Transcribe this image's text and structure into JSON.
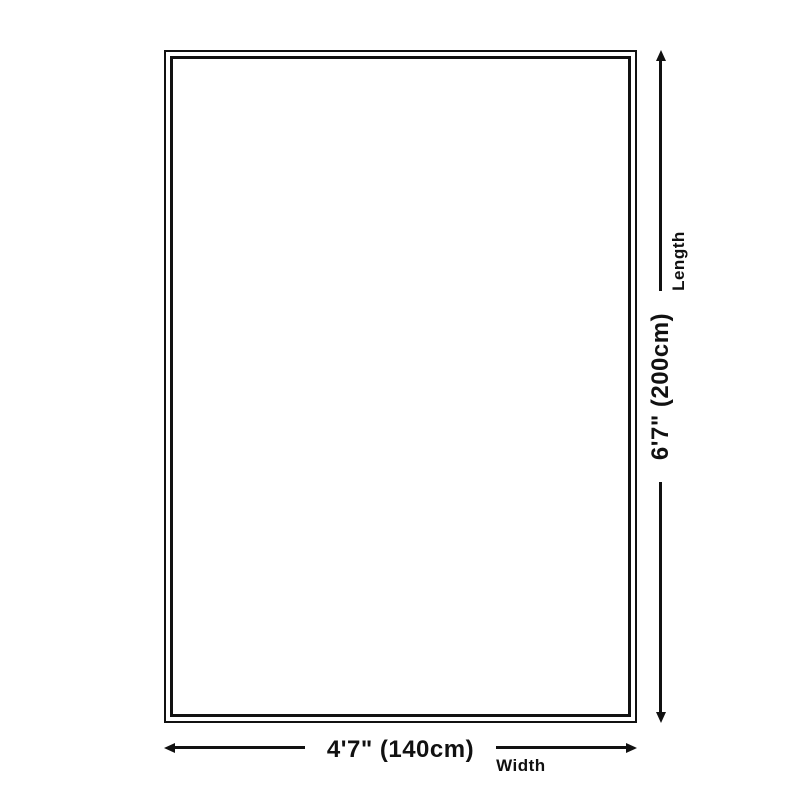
{
  "page": {
    "background_color": "#ffffff",
    "line_color": "#111111"
  },
  "diagram": {
    "kind": "rug-size-diagram",
    "rug": {
      "border_style": "double"
    },
    "width_dimension": {
      "value": "4'7\" (140cm)",
      "caption": "Width"
    },
    "length_dimension": {
      "value": "6'7\" (200cm)",
      "caption": "Length"
    }
  }
}
